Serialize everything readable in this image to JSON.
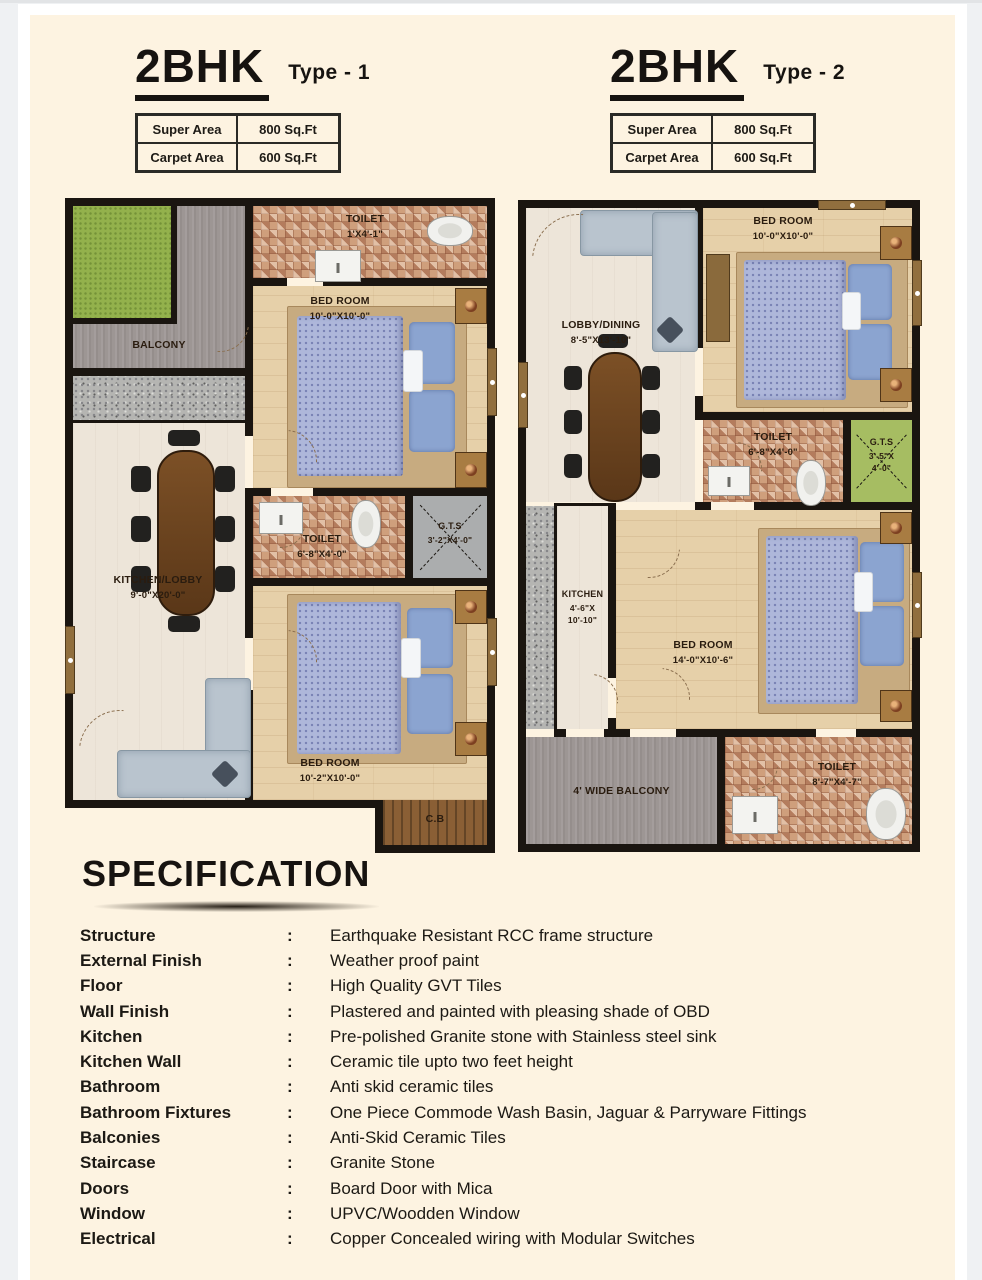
{
  "colors": {
    "page_background": "#fdf3e1",
    "outer_background": "#eff1f3",
    "wall_black": "#1a1510",
    "tile_brown": "#cf9f7c",
    "floor_beige": "#e6d0a9",
    "floor_light": "#ede5d9",
    "balcony_gray": "#9d9694",
    "grass_green": "#93b14c",
    "gts_green": "#a6bd62",
    "gts_gray": "#abadae",
    "bed_blue": "#aeb7da",
    "wood_brown": "#8a5f35"
  },
  "plans": [
    {
      "title": "2BHK",
      "type_label": "Type - 1",
      "area_table": [
        {
          "label": "Super Area",
          "value": "800 Sq.Ft"
        },
        {
          "label": "Carpet Area",
          "value": "600 Sq.Ft"
        }
      ],
      "rooms": {
        "balcony": {
          "name": "BALCONY"
        },
        "toilet_top": {
          "name": "TOILET",
          "dims": "1'X4'-1\""
        },
        "bedroom_top": {
          "name": "BED ROOM",
          "dims": "10'-0\"X10'-0\""
        },
        "kitchen_lobby": {
          "name": "KITCHEN/LOBBY",
          "dims": "9'-0\"X20'-0\""
        },
        "toilet_mid": {
          "name": "TOILET",
          "dims": "6'-8\"X4'-0\""
        },
        "gts": {
          "name": "G.T.S",
          "dims": "3'-2\"X4'-0\""
        },
        "bedroom_bottom": {
          "name": "BED ROOM",
          "dims": "10'-2\"X10'-0\""
        },
        "cupboard": {
          "name": "C.B"
        }
      }
    },
    {
      "title": "2BHK",
      "type_label": "Type - 2",
      "area_table": [
        {
          "label": "Super Area",
          "value": "800 Sq.Ft"
        },
        {
          "label": "Carpet Area",
          "value": "600 Sq.Ft"
        }
      ],
      "rooms": {
        "bedroom_top": {
          "name": "BED ROOM",
          "dims": "10'-0\"X10'-0\""
        },
        "lobby_dining": {
          "name": "LOBBY/DINING",
          "dims": "8'-5\"X13'-10\""
        },
        "toilet_mid": {
          "name": "TOILET",
          "dims": "6'-8\"X4'-0\""
        },
        "gts": {
          "name": "G.T.S",
          "dims_1": "3'-5\"X",
          "dims_2": "4'-0\""
        },
        "kitchen": {
          "name": "KITCHEN",
          "dims_1": "4'-6\"X",
          "dims_2": "10'-10\""
        },
        "bedroom_main": {
          "name": "BED ROOM",
          "dims": "14'-0\"X10'-6\""
        },
        "balcony": {
          "name": "4' WIDE BALCONY"
        },
        "toilet_bottom": {
          "name": "TOILET",
          "dims": "8'-7\"X4'-7\""
        }
      }
    }
  ],
  "specification": {
    "heading": "SPECIFICATION",
    "colon": ":",
    "items": [
      {
        "label": "Structure",
        "value": "Earthquake Resistant RCC frame structure"
      },
      {
        "label": "External Finish",
        "value": "Weather proof paint"
      },
      {
        "label": "Floor",
        "value": "High Quality GVT Tiles"
      },
      {
        "label": "Wall Finish",
        "value": "Plastered and painted with pleasing shade of OBD"
      },
      {
        "label": "Kitchen",
        "value": "Pre-polished Granite stone with Stainless steel sink"
      },
      {
        "label": "Kitchen Wall",
        "value": "Ceramic tile upto two feet height"
      },
      {
        "label": "Bathroom",
        "value": "Anti skid ceramic tiles"
      },
      {
        "label": "Bathroom Fixtures",
        "value": "One Piece Commode Wash Basin, Jaguar & Parryware Fittings"
      },
      {
        "label": "Balconies",
        "value": "Anti-Skid Ceramic Tiles"
      },
      {
        "label": "Staircase",
        "value": "Granite Stone"
      },
      {
        "label": "Doors",
        "value": "Board Door with Mica"
      },
      {
        "label": "Window",
        "value": "UPVC/Woodden Window"
      },
      {
        "label": "Electrical",
        "value": "Copper Concealed wiring with Modular Switches"
      }
    ]
  }
}
